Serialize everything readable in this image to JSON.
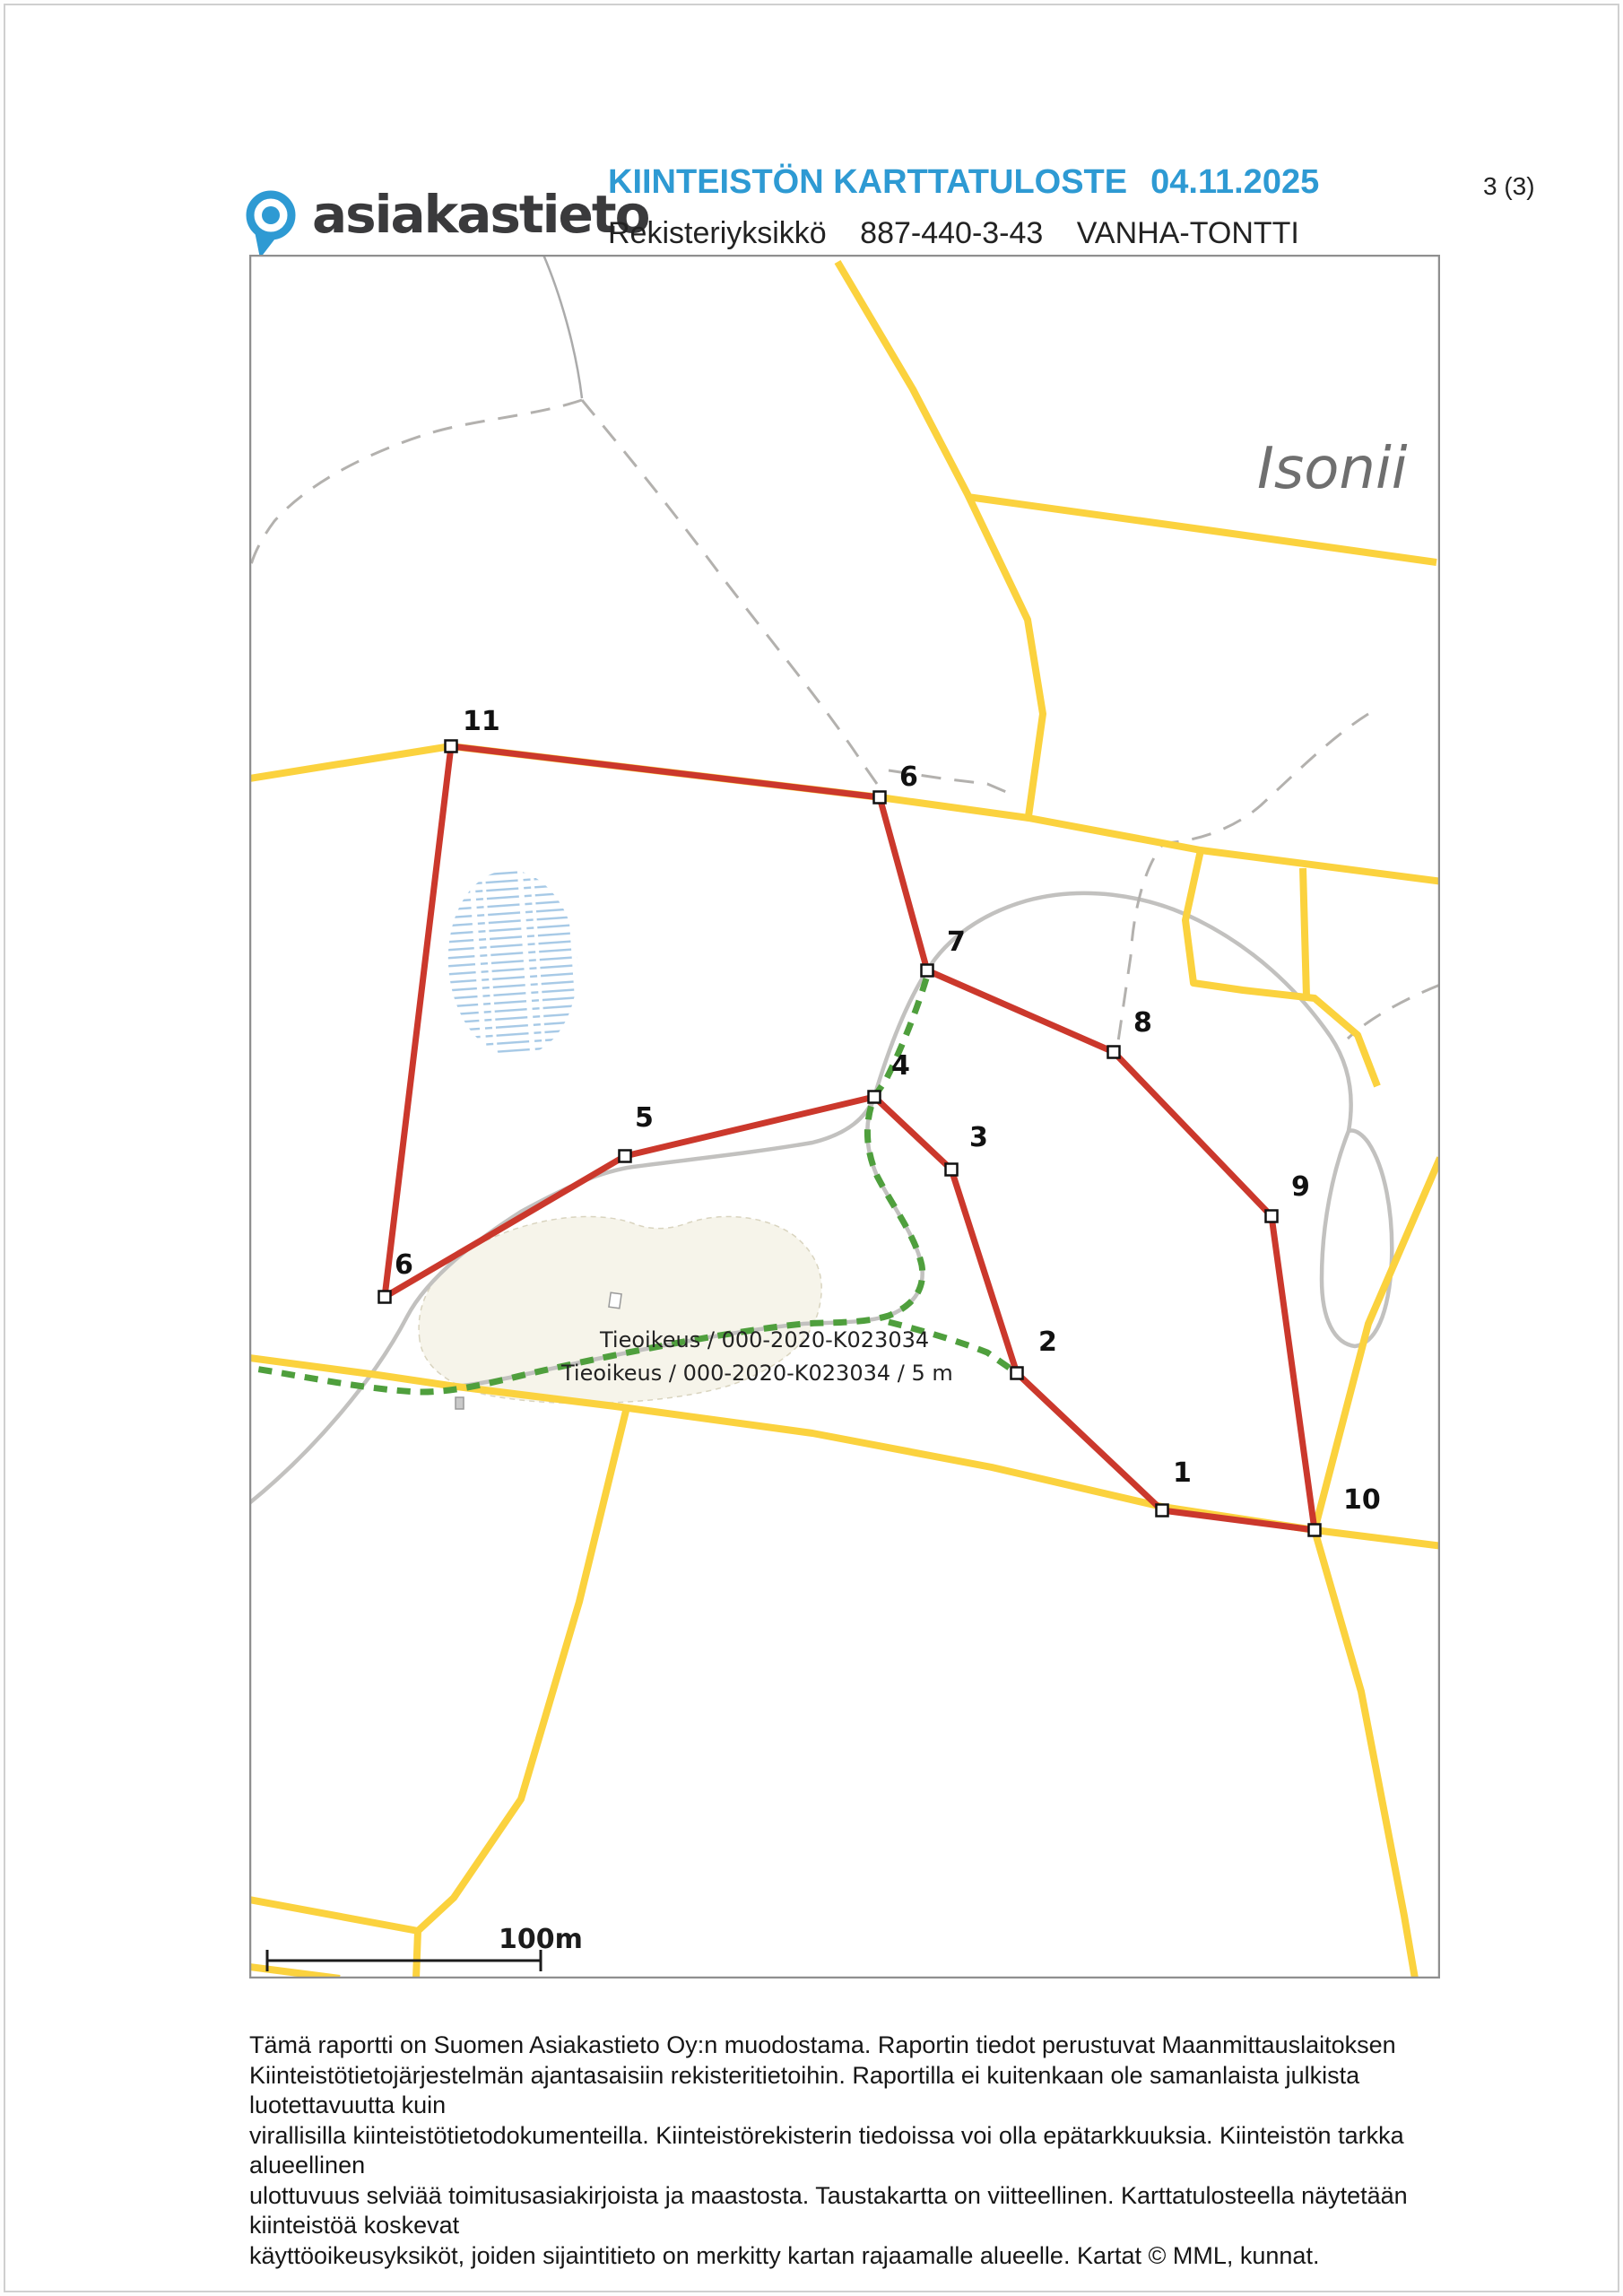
{
  "header": {
    "logo_text": "asiakastieto",
    "title": "KIINTEISTÖN KARTTATULOSTE",
    "date": "04.11.2025",
    "page_indicator": "3 (3)",
    "register_label": "Rekisteriyksikkö",
    "register_unit": "887-440-3-43",
    "property_name": "VANHA-TONTTI"
  },
  "map": {
    "place_name": "Isonii",
    "marker_labels": [
      "11",
      "6",
      "7",
      "8",
      "9",
      "10",
      "1",
      "2",
      "3",
      "4",
      "5",
      "6"
    ],
    "easement_label_1": "Tieoikeus / 000-2020-K023034",
    "easement_label_2": "Tieoikeus / 000-2020-K023034 / 5 m",
    "scale_label": "100m"
  },
  "legend_colors": {
    "boundary_red": "#cb382c",
    "road_yellow": "#fbd23e",
    "easement_green": "#4f9f3d",
    "background_road_gray": "#c2c1bf",
    "swamp_blue": "#a6c9e6",
    "title_blue": "#2e9ad3"
  },
  "footer": {
    "lines": [
      "Tämä raportti on Suomen Asiakastieto Oy:n muodostama. Raportin tiedot perustuvat Maanmittauslaitoksen",
      "Kiinteistötietojärjestelmän ajantasaisiin rekisteritietoihin. Raportilla ei kuitenkaan ole samanlaista julkista luotettavuutta kuin",
      "virallisilla kiinteistötietodokumenteilla. Kiinteistörekisterin tiedoissa voi olla epätarkkuuksia. Kiinteistön tarkka alueellinen",
      "ulottuvuus selviää toimitusasiakirjoista ja maastosta. Taustakartta on viitteellinen. Karttatulosteella näytetään kiinteistöä koskevat",
      "käyttöoikeusyksiköt, joiden sijaintitieto on merkitty kartan rajaamalle alueelle. Kartat © MML, kunnat."
    ]
  }
}
